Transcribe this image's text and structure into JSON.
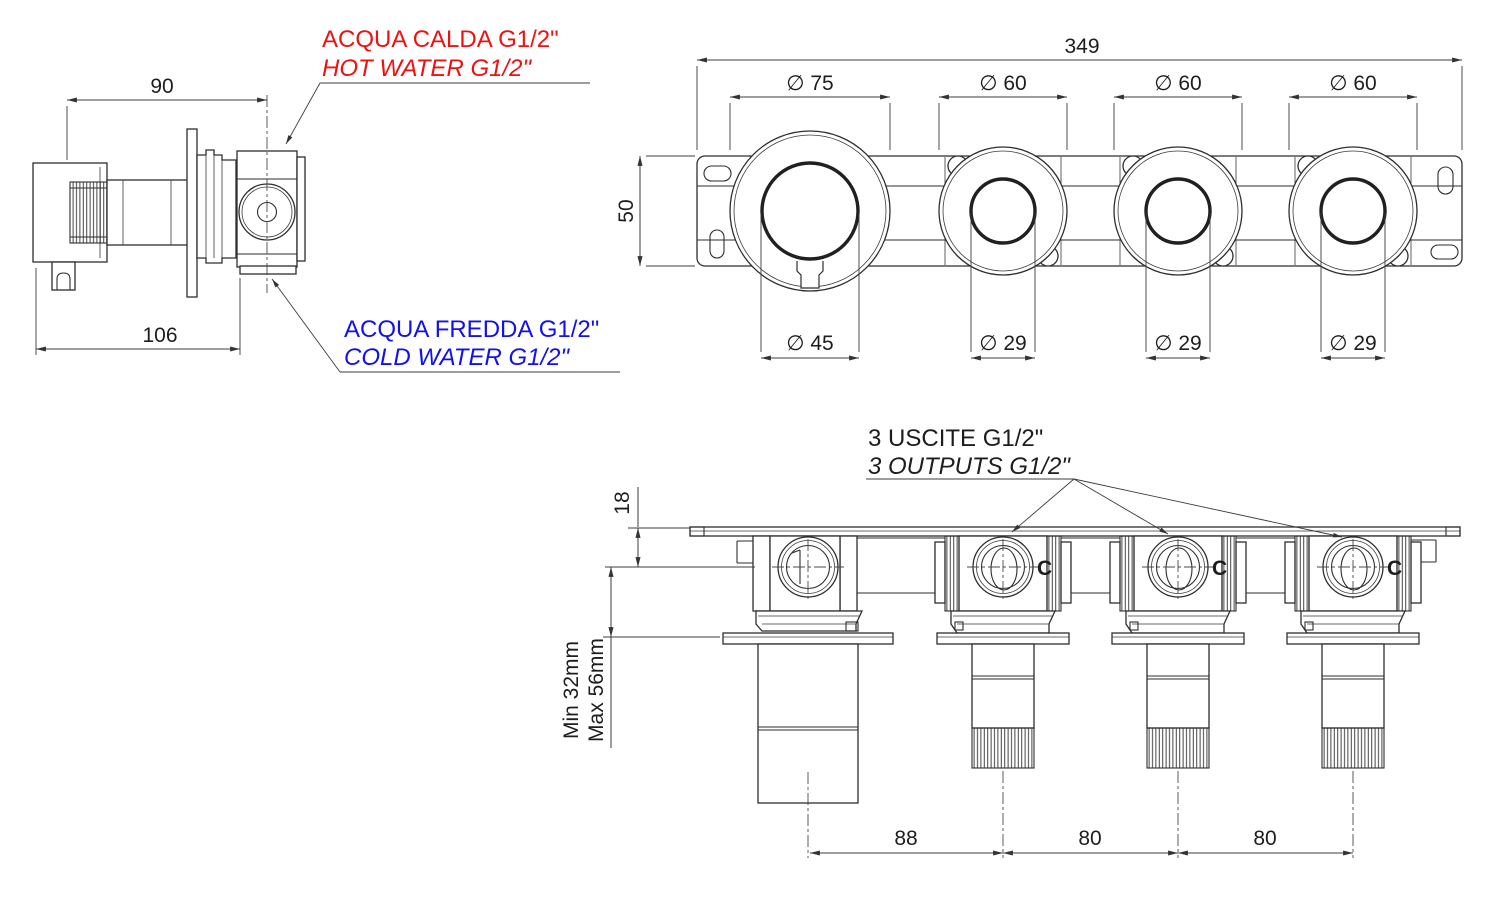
{
  "colors": {
    "hot_label": "#ee1111",
    "cold_label": "#1111ee",
    "line": "#2e2e2e"
  },
  "side_view": {
    "dim_top_width": "90",
    "dim_bottom_width": "106",
    "hot_water_label_it": "ACQUA CALDA G1/2\"",
    "hot_water_label_en": "HOT WATER G1/2\"",
    "cold_water_label_it": "ACQUA FREDDA G1/2\"",
    "cold_water_label_en": "COLD WATER G1/2\""
  },
  "front_view": {
    "dim_total_width": "349",
    "dim_plate_height": "50",
    "knob_outer_diameters": [
      "∅ 75",
      "∅ 60",
      "∅ 60",
      "∅ 60"
    ],
    "knob_inner_diameters": [
      "∅ 45",
      "∅ 29",
      "∅ 29",
      "∅ 29"
    ]
  },
  "bottom_view": {
    "outputs_label_it": "3 USCITE G1/2\"",
    "outputs_label_en": "3 OUTPUTS G1/2\"",
    "dim_plate_to_outlet": "18",
    "dim_depth_min": "Min 32mm",
    "dim_depth_max": "Max 56mm",
    "cold_port_letter": "C",
    "dim_center_spacings": [
      "88",
      "80",
      "80"
    ]
  }
}
